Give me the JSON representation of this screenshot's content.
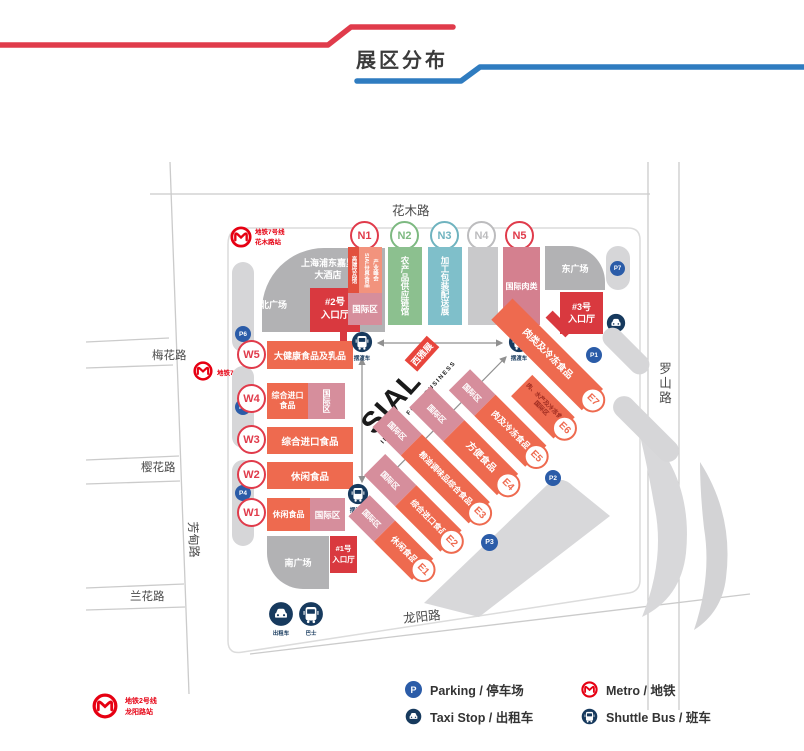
{
  "title": "展区分布",
  "colors": {
    "accent_red": "#e03b4b",
    "accent_blue": "#2f7cc0",
    "hall_orange": "#ee6a4f",
    "hall_pink": "#d68e9c",
    "hall_green": "#8cc08f",
    "hall_teal": "#7fbfca",
    "hall_gray": "#c9c9cb",
    "entrance_red": "#d9393f",
    "plaza_gray": "#b2b2b4",
    "parking_blue": "#2b5ca8",
    "transport_navy": "#173a5e",
    "metro_red": "#e60012"
  },
  "streets": {
    "north": "花木路",
    "east": "罗山路",
    "south": "龙阳路",
    "west": "芳甸路",
    "west_branch_1": "梅花路",
    "west_branch_2": "樱花路",
    "west_branch_3": "兰花路"
  },
  "metro": {
    "line7_station": "地铁7号线\n花木路站",
    "line7": "地铁7号线",
    "line2_station": "地铁2号线\n龙阳路站"
  },
  "plazas": {
    "hotel": "上海浦东嘉里\n大酒店",
    "north": "北广场",
    "east": "东广场",
    "south": "南广场"
  },
  "entrances": {
    "no1": "#1号\n入口厅",
    "no2": "#2号\n入口厅",
    "no3": "#3号\n入口厅"
  },
  "logo": {
    "brand": "SIAL",
    "brand_cn": "西雅展",
    "tagline": "INSPIRE FOOD BUSINESS"
  },
  "parking": {
    "p1": "P1",
    "p2": "P2",
    "p3": "P3",
    "p4": "P4",
    "p5": "P5",
    "p6": "P6",
    "p7": "P7"
  },
  "transport": {
    "taxi": "出租车",
    "bus": "巴士",
    "shuttle": "摆渡车",
    "taxi_east": "出租车"
  },
  "north_halls": {
    "n1": {
      "id": "N1",
      "strip": "高端饮品馆",
      "col1": "SIAL世界食品",
      "col2": "产业峰会",
      "intl": "国际区"
    },
    "n2": {
      "id": "N2",
      "label": "农产品供应链馆"
    },
    "n3": {
      "id": "N3",
      "label": "加工包装配送展"
    },
    "n4": {
      "id": "N4"
    },
    "n5": {
      "id": "N5",
      "label": "国际肉类"
    }
  },
  "west_halls": {
    "w5": {
      "id": "W5",
      "label": "大健康食品及乳品"
    },
    "w4": {
      "id": "W4",
      "label": "综合进口食品",
      "intl": "国际区"
    },
    "w3": {
      "id": "W3",
      "label": "综合进口食品"
    },
    "w2": {
      "id": "W2",
      "label": "休闲食品"
    },
    "w1": {
      "id": "W1",
      "label": "休闲食品",
      "intl": "国际区"
    }
  },
  "east_halls": {
    "e7": {
      "id": "E7",
      "label": "肉类及冷冻食品"
    },
    "e6": {
      "id": "E6",
      "label": "肉、水产及冷冻食品国际区"
    },
    "e5": {
      "id": "E5",
      "label": "肉及冷冻食品",
      "intl": "国际区"
    },
    "e4": {
      "id": "E4",
      "label": "方便食品",
      "intl": "国际区"
    },
    "e3": {
      "id": "E3",
      "label": "粮油调味品综合食品",
      "intl": "国际区"
    },
    "e2": {
      "id": "E2",
      "label": "综合进口食品",
      "intl": "国际区"
    },
    "e1": {
      "id": "E1",
      "label": "休闲食品",
      "intl": "国际区"
    }
  },
  "legend": {
    "parking": "Parking / 停车场",
    "taxi": "Taxi Stop / 出租车",
    "metro": "Metro / 地铁",
    "shuttle": "Shuttle Bus / 班车"
  }
}
